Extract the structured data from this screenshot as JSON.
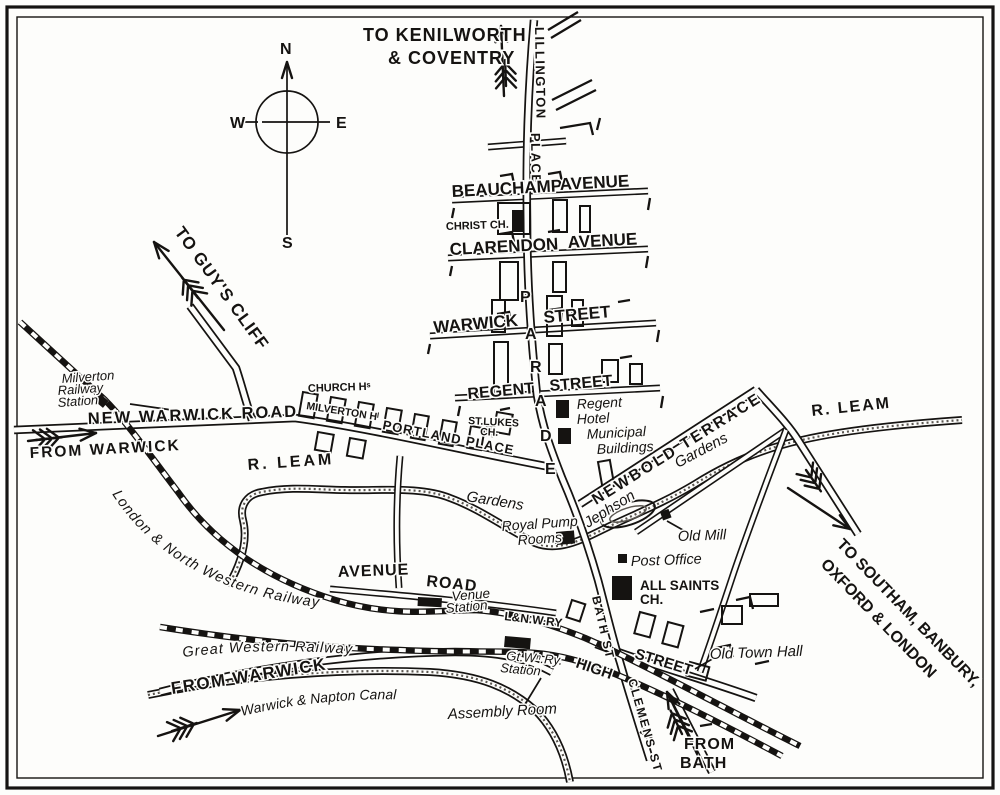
{
  "map": {
    "kind": "vintage town street map",
    "ink_color": "#151311",
    "paper_color": "#fdfdfb"
  },
  "compass": {
    "north": "N",
    "south": "S",
    "east": "E",
    "west": "W"
  },
  "routes": {
    "kenilworth_line1": "TO KENILWORTH",
    "kenilworth_line2": "& COVENTRY",
    "guys_cliff": "TO GUY'S CLIFF",
    "from_warwick_nw": "FROM WARWICK",
    "from_warwick_sw": "FROM WARWICK",
    "from_bath_line1": "FROM",
    "from_bath_line2": "BATH",
    "southam_line1": "TO SOUTHAM, BANBURY,",
    "southam_line2": "OXFORD & LONDON"
  },
  "streets": {
    "lillington": "LILLINGTON",
    "place": "PLACE",
    "beauchamp_word1": "BEAUCHAMP",
    "beauchamp_word2": "AVENUE",
    "clarendon_word1": "CLARENDON",
    "clarendon_word2": "AVENUE",
    "warwick_word1": "WARWICK",
    "warwick_word2": "STREET",
    "parade": [
      "P",
      "A",
      "R",
      "A",
      "D",
      "E"
    ],
    "regent_word1": "REGENT",
    "regent_word2": "STREET",
    "new_warwick_road": "NEW WARWICK ROAD",
    "church_hill": "CHURCH Hˢ",
    "milverton_hill": "MILVERTON Hˡ",
    "portland_place": "PORTLAND PLACE",
    "newbold_terrace": "NEWBOLD TERRACE",
    "avenue_word1": "AVENUE",
    "avenue_word2": "ROAD",
    "bath_street": "BATH ST",
    "high_word1": "HIGH",
    "high_word2": "STREET",
    "clemens_street": "CLEMENS ST"
  },
  "waterways": {
    "r_leam_west": "R. LEAM",
    "r_leam_east": "R. LEAM",
    "canal": "Warwick & Napton Canal"
  },
  "railways": {
    "lnwr": "London & North Western Railway",
    "gwr": "Great Western Railway",
    "lnwr_station_abbrev": "L&N.W.RY"
  },
  "places": {
    "milverton_line1": "Milverton",
    "milverton_line2": "Railway",
    "milverton_line3": "Station",
    "christ_church": "CHRIST CH.",
    "st_lukes_line1": "ST.LUKES",
    "st_lukes_line2": "CH.",
    "regent_hotel_line1": "Regent",
    "regent_hotel_line2": "Hotel",
    "municipal_line1": "Municipal",
    "municipal_line2": "Buildings",
    "jephson": "Jephson",
    "jephson_gardens": "Gardens",
    "pump_gardens": "Gardens",
    "pump_rooms_line1": "Royal Pump",
    "pump_rooms_line2": "Rooms",
    "old_mill": "Old Mill",
    "post_office": "Post Office",
    "avenue_station_line1": "Venue",
    "avenue_station_line2": "Station",
    "gwr_station_line1": "Gt.Wⁿ.Ry.",
    "gwr_station_line2": "Station",
    "all_saints_line1": "ALL SAINTS",
    "all_saints_line2": "CH.",
    "old_town_hall": "Old Town Hall",
    "assembly_room": "Assembly Room"
  }
}
